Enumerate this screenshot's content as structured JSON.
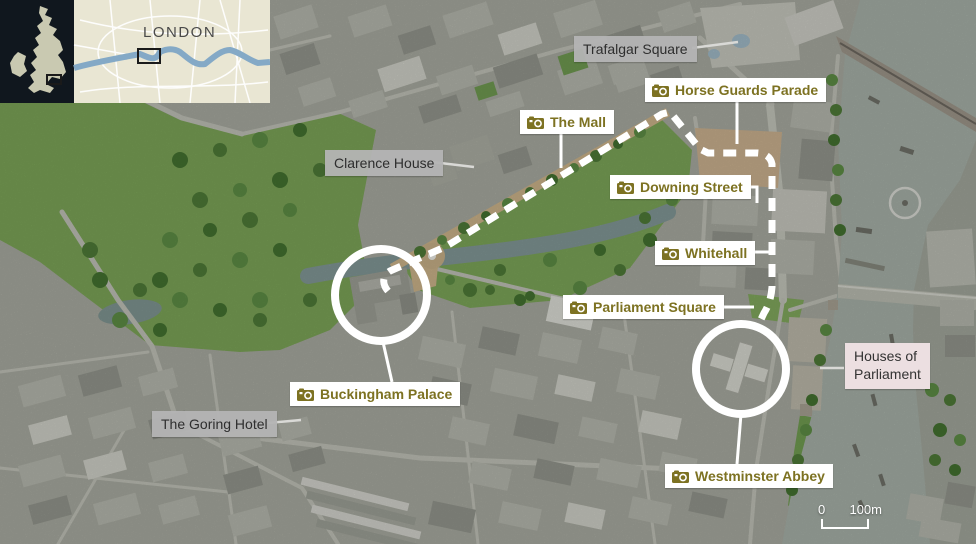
{
  "inset": {
    "region_label": "LONDON",
    "uk_panel_color": "#10171e",
    "uk_land_color": "#c9c9b1",
    "map_bg_color": "#e9e6d3",
    "river_color": "#84a9c6"
  },
  "map_labels": [
    {
      "id": "trafalgar-square",
      "text": "Trafalgar Square",
      "style": "plain",
      "x": 574,
      "y": 36
    },
    {
      "id": "horse-guards-parade",
      "text": "Horse Guards Parade",
      "style": "poi",
      "x": 645,
      "y": 78
    },
    {
      "id": "the-mall",
      "text": "The Mall",
      "style": "poi",
      "x": 520,
      "y": 110
    },
    {
      "id": "clarence-house",
      "text": "Clarence House",
      "style": "plain",
      "x": 325,
      "y": 150
    },
    {
      "id": "downing-street",
      "text": "Downing Street",
      "style": "poi",
      "x": 610,
      "y": 175
    },
    {
      "id": "whitehall",
      "text": "Whitehall",
      "style": "poi",
      "x": 655,
      "y": 241
    },
    {
      "id": "parliament-square",
      "text": "Parliament Square",
      "style": "poi",
      "x": 563,
      "y": 295
    },
    {
      "id": "buckingham-palace",
      "text": "Buckingham Palace",
      "style": "poi",
      "x": 290,
      "y": 382
    },
    {
      "id": "the-goring-hotel",
      "text": "The Goring Hotel",
      "style": "plain",
      "x": 152,
      "y": 411
    },
    {
      "id": "houses-of-parliament",
      "text": "Houses of Parliament",
      "style": "area",
      "x": 845,
      "y": 343,
      "lines": [
        "Houses of",
        "Parliament"
      ]
    },
    {
      "id": "westminster-abbey",
      "text": "Westminster Abbey",
      "style": "poi",
      "x": 665,
      "y": 464
    }
  ],
  "icons": {
    "poi_icon": "camera-icon"
  },
  "scale_bar": {
    "zero": "0",
    "distance": "100m"
  },
  "colors": {
    "poi_text": "#7d7222",
    "plain_label_bg": "#b4b4b4",
    "area_label_bg": "#ecdfe1",
    "route_color": "#ffffff",
    "park_green": "#79a156",
    "river_gray_green": "#a3ada4"
  }
}
